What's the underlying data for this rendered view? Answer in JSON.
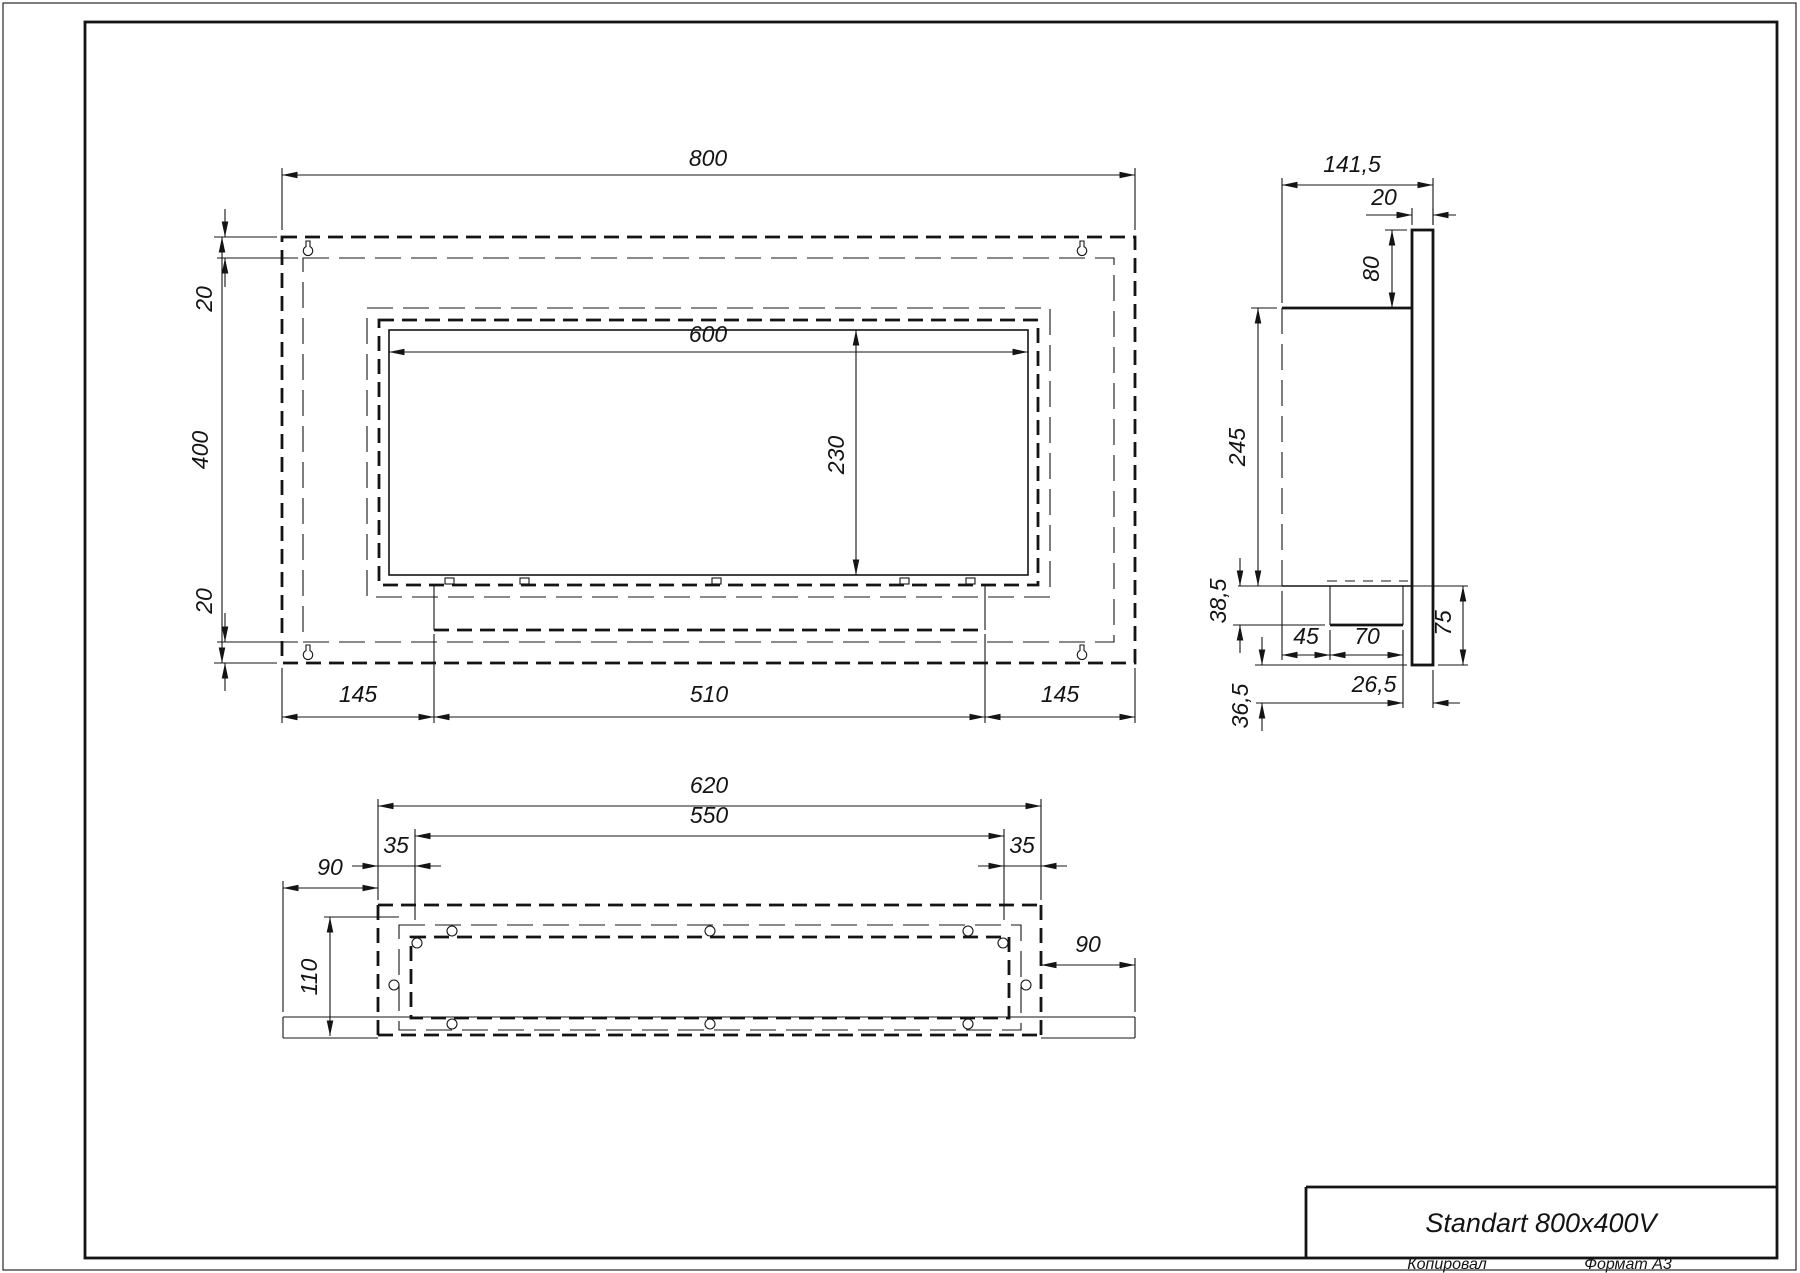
{
  "title_block": {
    "product_title": "Standart 800x400V"
  },
  "footer": {
    "copied_label": "Копировал",
    "format_label": "Формат А3"
  },
  "front_view": {
    "dims": {
      "overall_width": "800",
      "overall_height": "400",
      "top_flange": "20",
      "bottom_flange": "20",
      "opening_width": "600",
      "opening_height": "230",
      "left_offset": "145",
      "tray_width": "510",
      "right_offset": "145"
    }
  },
  "side_view": {
    "dims": {
      "overall_depth": "141,5",
      "front_panel_thickness": "20",
      "top_drop": "80",
      "body_height": "245",
      "burner_drop": "38,5",
      "bottom_drop": "36,5",
      "burner_offset": "45",
      "burner_width": "70",
      "lower_ledge": "75",
      "rear_offset": "26,5"
    }
  },
  "bottom_view": {
    "dims": {
      "body_width": "620",
      "stud_span": "550",
      "left_inset": "35",
      "right_inset": "35",
      "left_overhang": "90",
      "right_overhang": "90",
      "inner_depth": "110"
    }
  },
  "colors": {
    "ink": "#141414",
    "paper": "#ffffff"
  }
}
